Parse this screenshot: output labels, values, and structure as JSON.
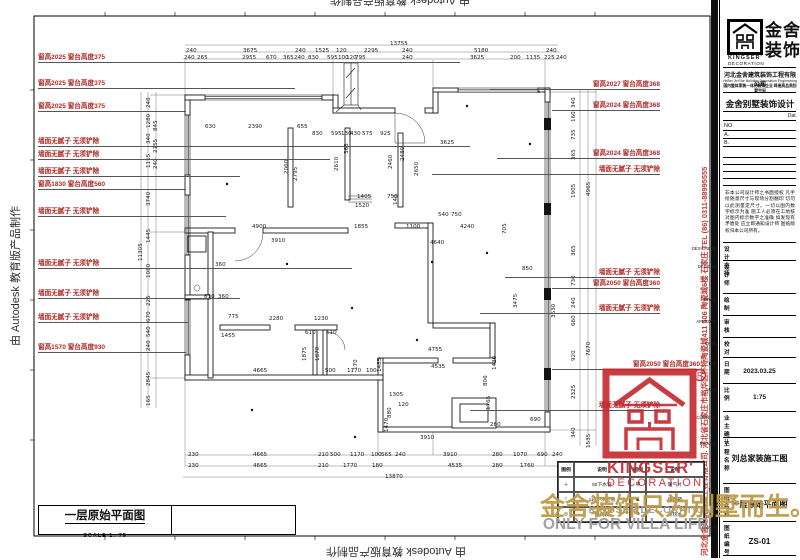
{
  "watermarks": {
    "autodesk": "由 Autodesk 教育版产品制作"
  },
  "side_strip": "河北金舍建筑装饰工程有限公司. 河北省石家庄市裕华区怀特陶瓷城411 506 陶瓷城6楼 石家庄 TEL (86) 0311-88995555",
  "gold_mark": {
    "main": "金舍装饰只为别墅而生。",
    "en1": "KINGSER'DECORATION",
    "en2": "ONLY FOR VILLA LIFE."
  },
  "stamp": {
    "line1": "KINGSER'",
    "line2": "DECORATION",
    "reg": "R"
  },
  "view_label": {
    "title": "一层原始平面图",
    "scale": "SCALE 1: 75"
  },
  "legend": {
    "headers": [
      "图例",
      "说明",
      "图例",
      "说明"
    ],
    "rows": [
      [
        "＋",
        "50下水管",
        "▤",
        "暖气片"
      ],
      [
        "○",
        "110下水立管",
        "◣",
        "强电箱"
      ],
      [
        "◎",
        "燃气表",
        "⊕",
        "冷热水"
      ]
    ]
  },
  "title_block": {
    "brand_cn_1": "金舍",
    "brand_cn_2": "装饰",
    "brand_en_1": "KINGSER'",
    "brand_en_2": "DECORATION",
    "company": "河北金舍建筑装饰工程有限公司",
    "company_en": "HeBei JinShe Building Decoration Engineering Co.,Ltd",
    "company_sub": "国内整体家装一体化装饰企业 缔造高品质别墅空间",
    "program": "金舍别墅装饰设计",
    "date_small": "Dat.",
    "no_label": "NO.",
    "a_label": "A.",
    "b_label": "B.",
    "note": "非本公司设计师之书面授权 凡手绘随意尺寸与现场分割翻印 切勿以此测量定尺寸。一切以图内数字标示为准 施工人必须在工地核对图内标示数字之准确 如发现有矛盾处 应立即通知设计师 图纸版权归本公司所有。",
    "rows": [
      {
        "cn": "设计主持",
        "en": "DESIGNERS",
        "val": ""
      },
      {
        "cn": "设计师",
        "en": "DESIGNE",
        "val": ""
      },
      {
        "cn": "绘制",
        "en": "DRAW",
        "val": ""
      },
      {
        "cn": "审核",
        "en": "APPROVE",
        "val": ""
      },
      {
        "cn": "校对",
        "en": "CHEC",
        "val": ""
      },
      {
        "cn": "日期",
        "en": "DAT",
        "val": "2023.03.25"
      },
      {
        "cn": "比例",
        "en": "SCAL",
        "val": "1:75"
      },
      {
        "cn": "业主确认",
        "en": "CLIENTEL",
        "val": ""
      },
      {
        "cn": "工程名称",
        "en": "PROJEC",
        "val": "刘总家装施工图"
      },
      {
        "cn": "图纸名称",
        "en": "TITL",
        "val": "一层原始平面图"
      },
      {
        "cn": "图纸编号",
        "en": "DWG.N",
        "val": "ZS-01"
      }
    ]
  },
  "plan": {
    "left_labels": [
      {
        "text": "窗高2025 窗台高度375",
        "y": 62,
        "end": 460
      },
      {
        "text": "窗高2025 窗台高度375",
        "y": 88,
        "end": 295
      },
      {
        "text": "窗高2025 窗台高度375",
        "y": 111,
        "end": 186
      },
      {
        "text": "墙面无腻子 无须铲除",
        "y": 146,
        "end": 470
      },
      {
        "text": "墙面无腻子 无须铲除",
        "y": 159,
        "end": 330
      },
      {
        "text": "墙面无腻子 无须铲除",
        "y": 176,
        "end": 240
      },
      {
        "text": "窗高1830 窗台高度560",
        "y": 189,
        "end": 186
      },
      {
        "text": "墙面无腻子 无须铲除",
        "y": 216,
        "end": 226
      },
      {
        "text": "墙面无腻子 无须铲除",
        "y": 268,
        "end": 352
      },
      {
        "text": "墙面无腻子 无须铲除",
        "y": 298,
        "end": 240
      },
      {
        "text": "墙面无腻子 无须铲除",
        "y": 322,
        "end": 188
      },
      {
        "text": "窗高1570 窗台高度930",
        "y": 352,
        "end": 186
      }
    ],
    "right_labels": [
      {
        "text": "窗高2027 窗台高度368",
        "y": 89,
        "start": 490
      },
      {
        "text": "窗高2024 窗台高度368",
        "y": 110,
        "start": 552
      },
      {
        "text": "窗高2024 窗台高度368",
        "y": 158,
        "start": 497
      },
      {
        "text": "墙面无腻子 无须铲除",
        "y": 174,
        "start": 432
      },
      {
        "text": "墙面无腻子 无须铲除",
        "y": 277,
        "start": 505
      },
      {
        "text": "窗高2050 窗台高度360",
        "y": 288,
        "start": 552
      },
      {
        "text": "墙面无腻子 无须铲除",
        "y": 313,
        "start": 480
      },
      {
        "text": "窗高2050 窗台高度360",
        "y": 369,
        "start": 552,
        "rx": 700
      },
      {
        "text": "墙面无腻子 无须铲除",
        "y": 410,
        "start": 470
      }
    ],
    "dims": [
      [
        390,
        41,
        "13755"
      ],
      [
        186,
        48,
        "240"
      ],
      [
        243,
        48,
        "3675"
      ],
      [
        295,
        48,
        "240"
      ],
      [
        315,
        48,
        "1525"
      ],
      [
        336,
        48,
        "120"
      ],
      [
        364,
        48,
        "2295"
      ],
      [
        402,
        48,
        "240"
      ],
      [
        474,
        48,
        "5180"
      ],
      [
        546,
        48,
        "240"
      ],
      [
        184,
        55,
        "240"
      ],
      [
        197,
        55,
        "265"
      ],
      [
        242,
        55,
        "2955"
      ],
      [
        266,
        55,
        "670"
      ],
      [
        283,
        55,
        "365"
      ],
      [
        294,
        55,
        "240"
      ],
      [
        308,
        55,
        "830"
      ],
      [
        327,
        55,
        "595"
      ],
      [
        338,
        55,
        "100"
      ],
      [
        346,
        55,
        "120"
      ],
      [
        355,
        55,
        "795"
      ],
      [
        402,
        55,
        "240"
      ],
      [
        470,
        55,
        "3625"
      ],
      [
        510,
        55,
        "200"
      ],
      [
        526,
        55,
        "1135"
      ],
      [
        544,
        55,
        "225"
      ],
      [
        556,
        55,
        "240"
      ],
      [
        152,
        102,
        "240",
        1
      ],
      [
        152,
        122,
        "1280",
        1
      ],
      [
        152,
        138,
        "340",
        1
      ],
      [
        152,
        162,
        "1115",
        1
      ],
      [
        152,
        200,
        "3740",
        1
      ],
      [
        152,
        237,
        "1445",
        1
      ],
      [
        152,
        272,
        "1080",
        1
      ],
      [
        152,
        300,
        "225",
        1
      ],
      [
        152,
        316,
        "670",
        1
      ],
      [
        152,
        331,
        "540",
        1
      ],
      [
        152,
        345,
        "240",
        1
      ],
      [
        152,
        380,
        "2845",
        1
      ],
      [
        152,
        400,
        "165",
        1
      ],
      [
        159,
        125,
        "845",
        1
      ],
      [
        159,
        147,
        "2155",
        1
      ],
      [
        159,
        163,
        "240",
        1
      ],
      [
        144,
        255,
        "11305",
        1
      ],
      [
        577,
        102,
        "340",
        1
      ],
      [
        577,
        116,
        "160",
        1
      ],
      [
        577,
        134,
        "735",
        1
      ],
      [
        577,
        154,
        "365",
        1
      ],
      [
        577,
        192,
        "1905",
        1
      ],
      [
        577,
        250,
        "365",
        1
      ],
      [
        577,
        280,
        "730",
        1
      ],
      [
        577,
        302,
        "240",
        1
      ],
      [
        577,
        320,
        "660",
        1
      ],
      [
        577,
        355,
        "920",
        1
      ],
      [
        577,
        393,
        "2325",
        1
      ],
      [
        577,
        432,
        "340",
        1
      ],
      [
        592,
        190,
        "4965",
        1
      ],
      [
        592,
        350,
        "7670",
        1
      ],
      [
        592,
        442,
        "1535",
        1
      ],
      [
        557,
        312,
        "3630",
        1
      ],
      [
        188,
        452,
        "230"
      ],
      [
        253,
        452,
        "4665"
      ],
      [
        318,
        452,
        "210"
      ],
      [
        330,
        452,
        "500"
      ],
      [
        350,
        452,
        "1170"
      ],
      [
        371,
        452,
        "100"
      ],
      [
        381,
        452,
        "565"
      ],
      [
        395,
        452,
        "240"
      ],
      [
        443,
        452,
        "3910"
      ],
      [
        492,
        452,
        "280"
      ],
      [
        513,
        452,
        "1070"
      ],
      [
        537,
        452,
        "690"
      ],
      [
        552,
        452,
        "240"
      ],
      [
        188,
        463,
        "230"
      ],
      [
        253,
        463,
        "4665"
      ],
      [
        318,
        463,
        "210"
      ],
      [
        343,
        463,
        "1770"
      ],
      [
        372,
        463,
        "180"
      ],
      [
        448,
        463,
        "4535"
      ],
      [
        492,
        463,
        "280"
      ],
      [
        520,
        463,
        "1760"
      ],
      [
        385,
        474,
        "13870"
      ],
      [
        205,
        124,
        "630"
      ],
      [
        248,
        124,
        "2390"
      ],
      [
        297,
        124,
        "655"
      ],
      [
        312,
        131,
        "830"
      ],
      [
        331,
        131,
        "595"
      ],
      [
        341,
        131,
        "130"
      ],
      [
        350,
        131,
        "430"
      ],
      [
        362,
        131,
        "575"
      ],
      [
        380,
        131,
        "925"
      ],
      [
        290,
        168,
        "2060",
        1
      ],
      [
        299,
        175,
        "2795",
        1
      ],
      [
        340,
        165,
        "2610",
        1
      ],
      [
        350,
        148,
        "365",
        1
      ],
      [
        406,
        155,
        "2480",
        1
      ],
      [
        420,
        170,
        "2650",
        1
      ],
      [
        394,
        163,
        "2460",
        1
      ],
      [
        357,
        194,
        "1405"
      ],
      [
        355,
        203,
        "1520"
      ],
      [
        387,
        194,
        "750"
      ],
      [
        399,
        199,
        "140",
        1
      ],
      [
        440,
        140,
        "3625"
      ],
      [
        252,
        224,
        "4900"
      ],
      [
        354,
        224,
        "1855"
      ],
      [
        406,
        224,
        "1100"
      ],
      [
        460,
        224,
        "4240"
      ],
      [
        430,
        240,
        "4640"
      ],
      [
        271,
        238,
        "3910"
      ],
      [
        508,
        228,
        "705",
        1
      ],
      [
        438,
        212,
        "540"
      ],
      [
        451,
        212,
        "750"
      ],
      [
        215,
        262,
        "360"
      ],
      [
        204,
        294,
        "610"
      ],
      [
        218,
        294,
        "360"
      ],
      [
        228,
        314,
        "775"
      ],
      [
        269,
        316,
        "2280"
      ],
      [
        314,
        316,
        "1230"
      ],
      [
        305,
        330,
        "610"
      ],
      [
        326,
        330,
        "610"
      ],
      [
        221,
        333,
        "1455"
      ],
      [
        308,
        355,
        "1875",
        1
      ],
      [
        321,
        355,
        "1870",
        1
      ],
      [
        253,
        368,
        "4665"
      ],
      [
        325,
        368,
        "500"
      ],
      [
        347,
        368,
        "1170"
      ],
      [
        359,
        364,
        "170",
        1
      ],
      [
        366,
        368,
        "100"
      ],
      [
        428,
        347,
        "4755"
      ],
      [
        431,
        364,
        "4535"
      ],
      [
        498,
        364,
        "1430",
        1
      ],
      [
        489,
        380,
        "806",
        1
      ],
      [
        519,
        302,
        "3475",
        1
      ],
      [
        522,
        266,
        "850"
      ],
      [
        492,
        404,
        "1765",
        1
      ],
      [
        530,
        417,
        "690"
      ],
      [
        490,
        422,
        "280"
      ],
      [
        420,
        435,
        "3910"
      ],
      [
        389,
        392,
        "1305"
      ],
      [
        398,
        402,
        "120"
      ],
      [
        393,
        412,
        "880",
        1
      ],
      [
        390,
        426,
        "1470",
        1
      ],
      [
        383,
        366,
        "1485",
        1
      ]
    ]
  }
}
